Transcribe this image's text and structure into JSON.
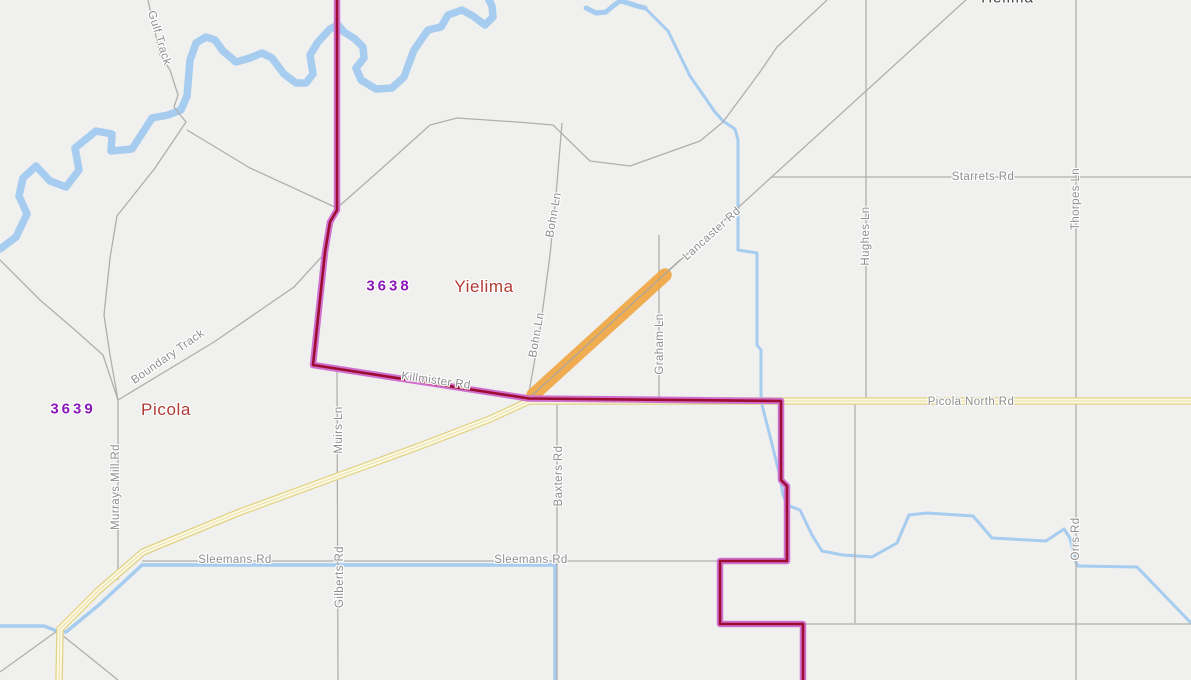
{
  "map": {
    "title": "Locality map of Yielima and Picola with highlighted segment of Lancaster Rd",
    "colors": {
      "background": "#f0f0ee",
      "water": "#a6ccf0",
      "minor_road": "#b0afac",
      "sealed_road_casing": "#e0d287",
      "sealed_road_fill": "#fcf9e2",
      "boundary_casing": "#cf70ce",
      "boundary_core": "#9d0c31",
      "highlight": "#f0a43e",
      "road_label": "#8d8d8d",
      "locality_code": "#8a16b8",
      "locality_name": "#b23a34"
    },
    "highlight": {
      "description": "selected road segment",
      "road": "Lancaster Rd",
      "color": "#f0a43e"
    },
    "localities": [
      {
        "code": "3638",
        "name": "Yielima"
      },
      {
        "code": "3639",
        "name": "Picola"
      }
    ],
    "labels": [
      {
        "id": "label-gulf-track",
        "text": "Gulf Track",
        "x": 159,
        "y": 38,
        "rot": 73,
        "type": "road-label"
      },
      {
        "id": "label-town-yielima",
        "text": "Yielima",
        "x": 1006,
        "y": -2,
        "rot": 0,
        "type": "town-name"
      },
      {
        "id": "label-starrets-rd",
        "text": "Starrets Rd",
        "x": 983,
        "y": 177,
        "rot": 0,
        "type": "road-label"
      },
      {
        "id": "label-thorpes-ln",
        "text": "Thorpes Ln",
        "x": 1076,
        "y": 199,
        "rot": -90,
        "type": "road-label"
      },
      {
        "id": "label-hughes-ln",
        "text": "Hughes Ln",
        "x": 866,
        "y": 236,
        "rot": -90,
        "type": "road-label"
      },
      {
        "id": "label-lancaster-rd",
        "text": "Lancaster Rd",
        "x": 712,
        "y": 234,
        "rot": -42,
        "type": "road-label"
      },
      {
        "id": "label-bohn-ln-north",
        "text": "Bohn Ln",
        "x": 554,
        "y": 215,
        "rot": -80,
        "type": "road-label"
      },
      {
        "id": "label-bohn-ln-south",
        "text": "Bohn Ln",
        "x": 537,
        "y": 335,
        "rot": -80,
        "type": "road-label"
      },
      {
        "id": "label-graham-ln",
        "text": "Graham Ln",
        "x": 660,
        "y": 344,
        "rot": -90,
        "type": "road-label"
      },
      {
        "id": "label-boundary-track",
        "text": "Boundary Track",
        "x": 168,
        "y": 357,
        "rot": -35,
        "type": "road-label"
      },
      {
        "id": "label-killmister-rd",
        "text": "Killmister Rd",
        "x": 436,
        "y": 381,
        "rot": 8,
        "type": "road-label"
      },
      {
        "id": "label-picola-north-rd",
        "text": "Picola North Rd",
        "x": 971,
        "y": 402,
        "rot": 0,
        "type": "road-label"
      },
      {
        "id": "label-code-3638",
        "text": "3638",
        "x": 389,
        "y": 286,
        "rot": 0,
        "type": "locality-code"
      },
      {
        "id": "label-locality-yielima",
        "text": "Yielima",
        "x": 484,
        "y": 287,
        "rot": 0,
        "type": "locality-name"
      },
      {
        "id": "label-code-3639",
        "text": "3639",
        "x": 73,
        "y": 409,
        "rot": 0,
        "type": "locality-code"
      },
      {
        "id": "label-locality-picola",
        "text": "Picola",
        "x": 166,
        "y": 410,
        "rot": 0,
        "type": "locality-name"
      },
      {
        "id": "label-murrays-mill-rd",
        "text": "Murrays Mill Rd",
        "x": 116,
        "y": 487,
        "rot": -90,
        "type": "road-label"
      },
      {
        "id": "label-muirs-ln",
        "text": "Muirs Ln",
        "x": 339,
        "y": 430,
        "rot": -90,
        "type": "road-label"
      },
      {
        "id": "label-gilberts-rd",
        "text": "Gilberts Rd",
        "x": 340,
        "y": 577,
        "rot": -90,
        "type": "road-label"
      },
      {
        "id": "label-baxters-rd",
        "text": "Baxters Rd",
        "x": 559,
        "y": 476,
        "rot": -90,
        "type": "road-label"
      },
      {
        "id": "label-sleemans-rd-west",
        "text": "Sleemans Rd",
        "x": 235,
        "y": 560,
        "rot": 0,
        "type": "road-label"
      },
      {
        "id": "label-sleemans-rd-east",
        "text": "Sleemans Rd",
        "x": 531,
        "y": 560,
        "rot": 0,
        "type": "road-label"
      },
      {
        "id": "label-orrs-rd",
        "text": "Orrs Rd",
        "x": 1076,
        "y": 539,
        "rot": -90,
        "type": "road-label"
      }
    ]
  }
}
